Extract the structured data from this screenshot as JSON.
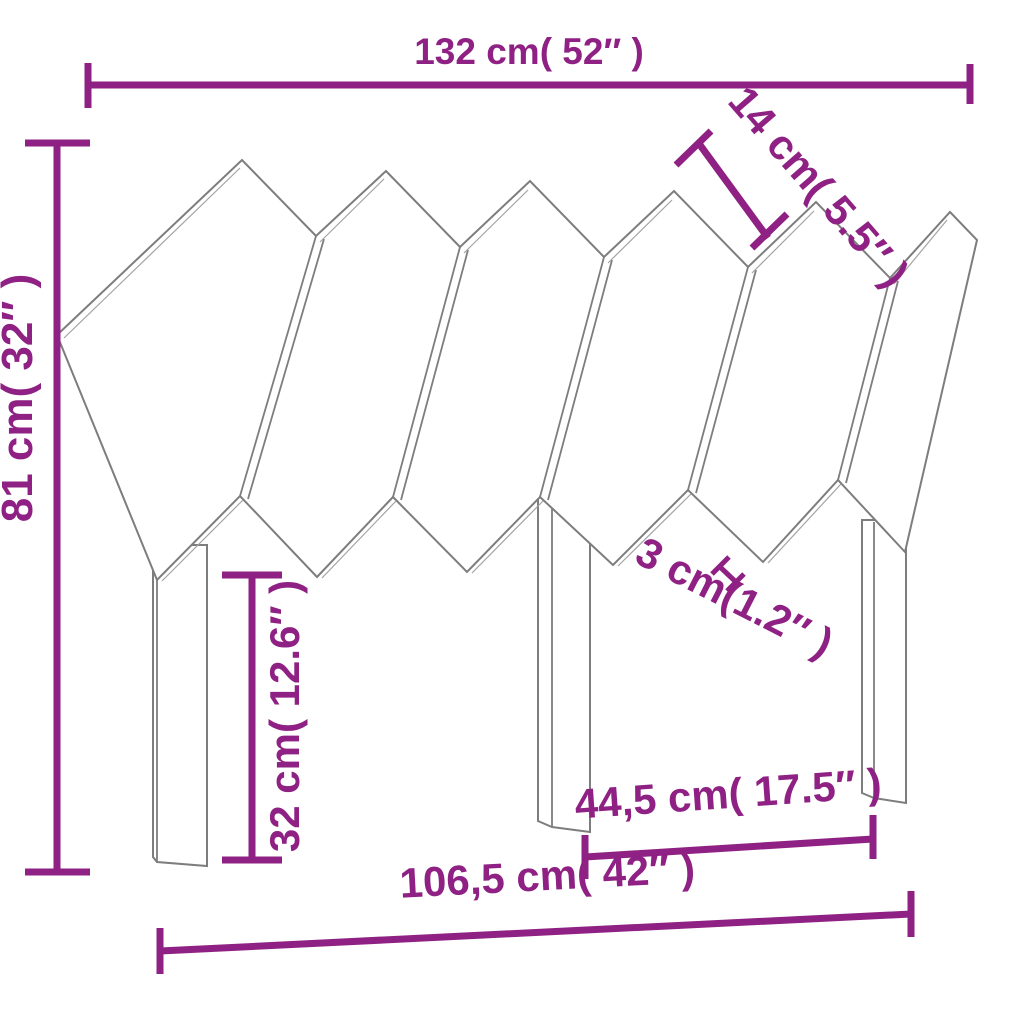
{
  "diagram": {
    "kind": "furniture-dimension-drawing",
    "subject": "herringbone-slat-headboard-with-three-legs",
    "colors": {
      "dimension_accent": "#8e2183",
      "drawing_outline": "#7d7d7d",
      "background": "#ffffff"
    },
    "dimensions": {
      "top_width": "132 cm( 52″ )",
      "slat_width": "14 cm( 5.5″ )",
      "total_height": "81 cm( 32″ )",
      "leg_height": "32 cm( 12.6″ )",
      "slat_gap": "3 cm(1.2″ )",
      "inner_leg_span": "44,5 cm( 17.5″ )",
      "bottom_width": "106,5 cm( 42″ )"
    }
  }
}
